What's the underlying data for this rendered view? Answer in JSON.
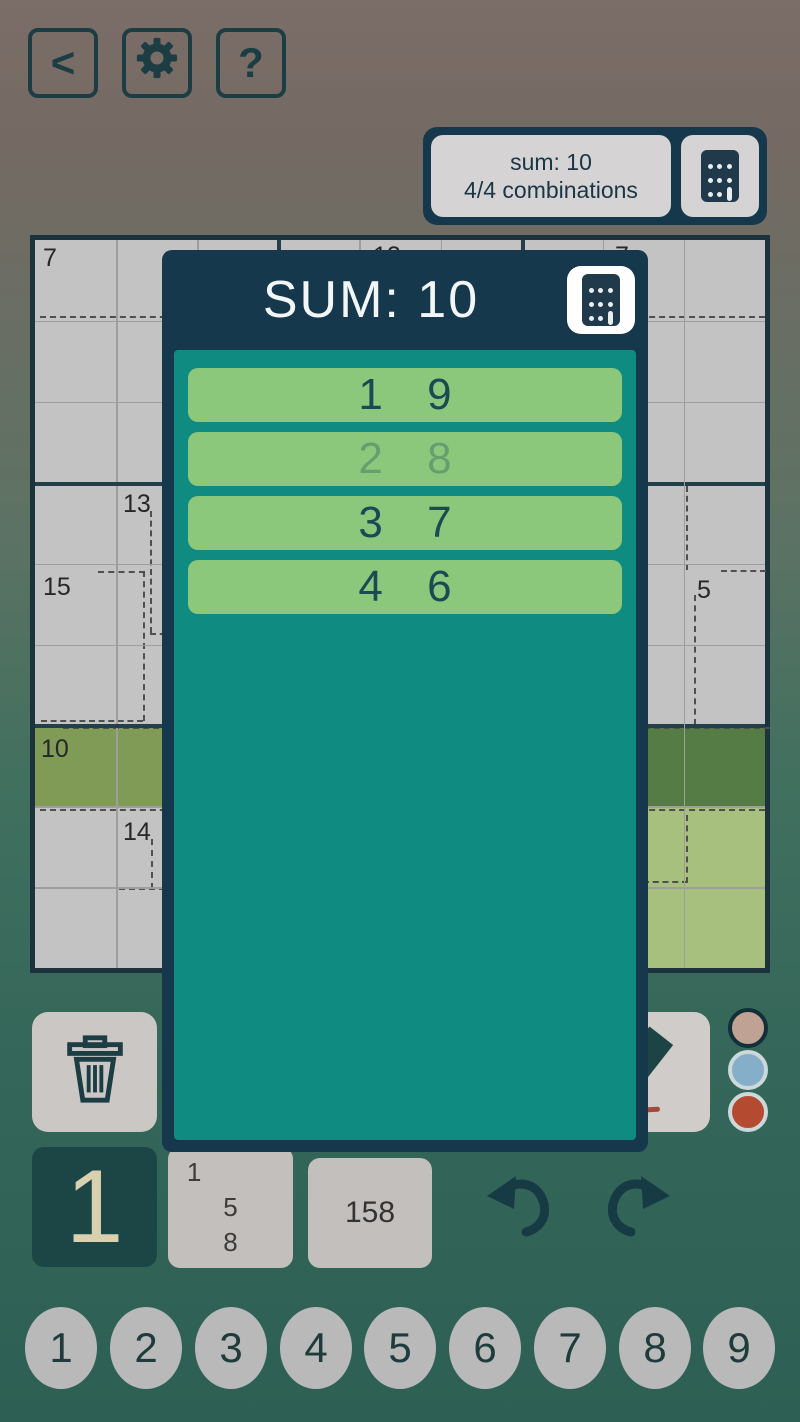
{
  "colors": {
    "background_top": "#7b6d67",
    "background_bottom": "#2d5f54",
    "accent_navy": "#16384c",
    "modal_teal": "#0f8b81",
    "combo_green": "#8cc87c",
    "highlight_row_green": "#7f9b55",
    "highlight_box_light": "#a8c07e",
    "highlight_box_dark": "#567c46",
    "selected_key_bg": "#1c4545",
    "selected_key_text": "#d8d0ae",
    "dot_beige": "#bfa294",
    "dot_blue": "#85afc9",
    "dot_red": "#b44b31"
  },
  "topbar": {
    "back_label": "<",
    "help_label": "?",
    "icons": [
      "back-chevron",
      "gear",
      "question-mark"
    ]
  },
  "sum_panel": {
    "sum_line": "sum: 10",
    "combos_line": "4/4 combinations",
    "icon": "calculator"
  },
  "modal": {
    "title": "SUM: 10",
    "icon": "calculator",
    "combinations": [
      {
        "text": "1 9",
        "faded": false
      },
      {
        "text": "2 8",
        "faded": true
      },
      {
        "text": "3 7",
        "faded": false
      },
      {
        "text": "4 6",
        "faded": false
      }
    ]
  },
  "grid": {
    "cages": [
      {
        "label": "7"
      },
      {
        "label": "12"
      },
      {
        "label": "7"
      },
      {
        "label": "13"
      },
      {
        "label": "15"
      },
      {
        "label": "5"
      },
      {
        "label": "10"
      },
      {
        "label": "14"
      }
    ]
  },
  "controls": {
    "icons": [
      "trash-can",
      "pencil"
    ],
    "color_dots": [
      "beige",
      "blue",
      "red"
    ]
  },
  "numpad": {
    "selected_number": "1",
    "pencil_marks": [
      "1",
      "5",
      "8"
    ],
    "cell_value": "158",
    "icons": [
      "undo-arrow",
      "redo-arrow"
    ]
  },
  "number_row": {
    "numbers": [
      "1",
      "2",
      "3",
      "4",
      "5",
      "6",
      "7",
      "8",
      "9"
    ]
  }
}
